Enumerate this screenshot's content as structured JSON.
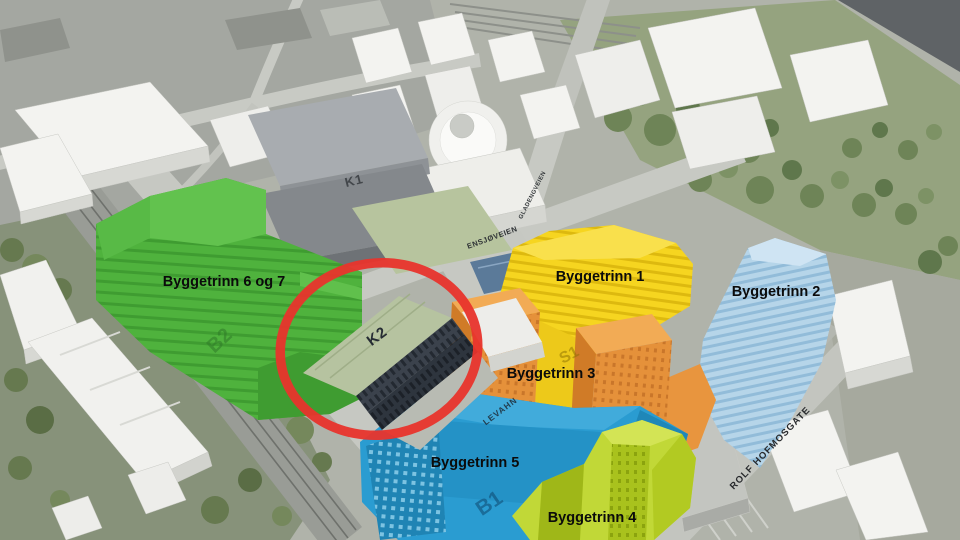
{
  "scene": {
    "type": "aerial-3d-site-plan",
    "background_color": "#b0b3aa",
    "highlight_color": "#e8342c"
  },
  "phases": [
    {
      "label": "Byggetrinn 1",
      "roof_code": "S1",
      "color": "#f6d520"
    },
    {
      "label": "Byggetrinn 2",
      "roof_code": "",
      "color": "#b6d5e9"
    },
    {
      "label": "Byggetrinn 3",
      "roof_code": "",
      "color": "#e8953e"
    },
    {
      "label": "Byggetrinn 4",
      "roof_code": "",
      "color": "#c1d837"
    },
    {
      "label": "Byggetrinn 5",
      "roof_code": "B1",
      "color": "#2a9cd1"
    },
    {
      "label": "Byggetrinn 6 og 7",
      "roof_code": "B2",
      "color": "#4fb23d"
    }
  ],
  "landmarks": [
    {
      "label": "K1",
      "highlighted": false
    },
    {
      "label": "K2",
      "highlighted": true
    }
  ],
  "roof_text": {
    "levahn": "LEVAHN"
  },
  "streets": [
    {
      "name": "GLADENGVEIEN"
    },
    {
      "name": "ENSJØVEIEN"
    },
    {
      "name": "ROLF HOFMOSGATE"
    }
  ]
}
